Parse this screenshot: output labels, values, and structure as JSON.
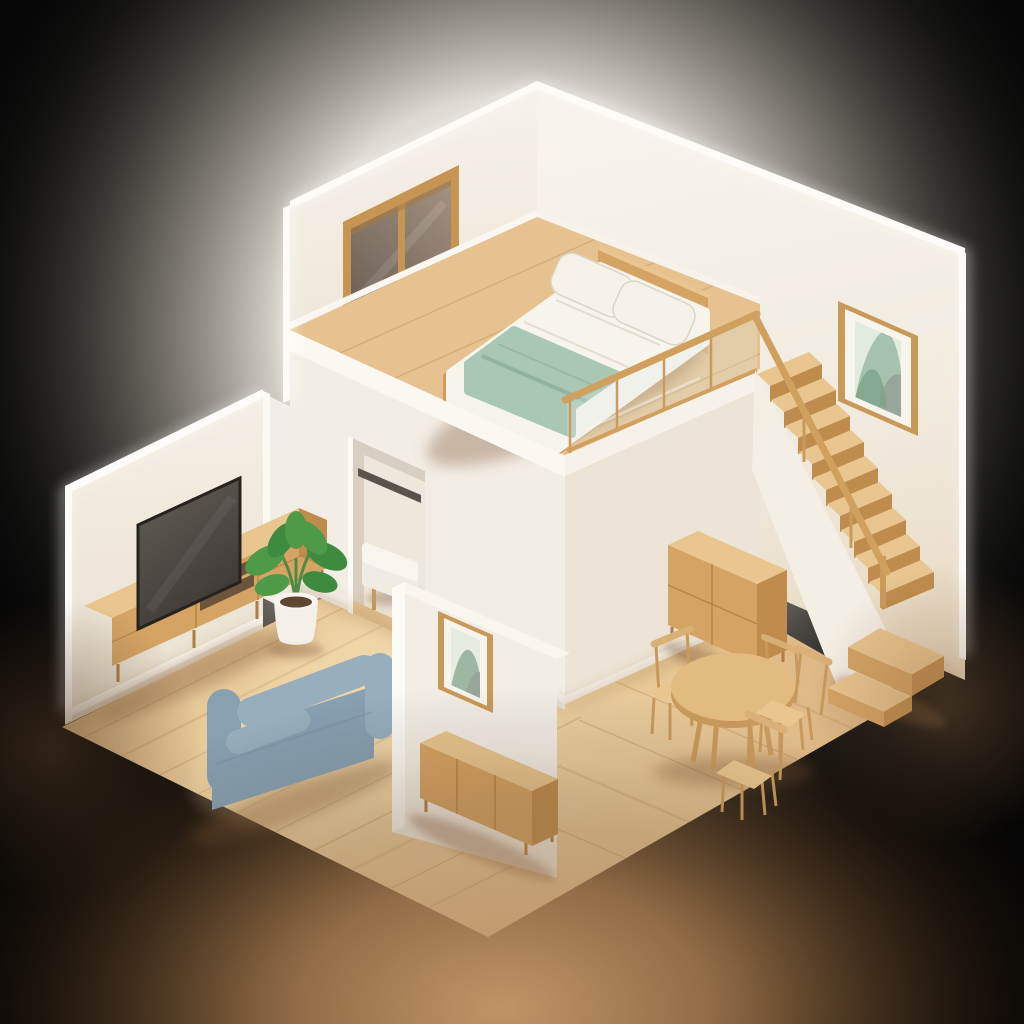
{
  "scene": {
    "type": "isometric-room-render",
    "description": "Isometric 3D cutaway render of a minimalist loft apartment: mezzanine bedroom with double bed, window and glass railing above; wooden staircase down the right wall; living area with TV, media console, potted plant and blue sofa; dining corner with round wooden table and chairs; framed green art prints; warm glow on black background",
    "style": "soft 3D render, warm minimalist, black vignette background with white halo and warm amber floor glow",
    "background": {
      "base": "#050505",
      "halo": "#ffffff",
      "warm_glow": "#b98a58"
    },
    "palette": {
      "wall": "#f3eee5",
      "wall2": "#ece4d6",
      "wall3": "#e9dfcf",
      "bright": "#fcfaf5",
      "wood": "#d5a464",
      "wood2": "#cf9c5c",
      "wood3": "#c08c4e",
      "woodTop": "#e9c68f",
      "plank": "#a87a46",
      "duvet": "#f7f4ec",
      "duvetShade": "#e3dbcb",
      "blanket": "#a9c8b4",
      "blanket2": "#8fb19d",
      "sofa": "#87a0b2",
      "sofa2": "#97aebd",
      "sofa3": "#7a93a6",
      "tv": "#45403b",
      "tv2": "#302c29",
      "leaf": "#4f9a47",
      "leaf2": "#3e8a3e",
      "pot": "#f4f0e8",
      "soil": "#5f4630",
      "glassPane": "#8d7d6f",
      "rail": "#cfa05e",
      "rod": "#5b534b",
      "artA": "#a4c2ac",
      "artB": "#7fa48c",
      "artC": "#98a59a",
      "artBg": "#e3ebdf"
    },
    "rooms": [
      {
        "name": "loft-bedroom",
        "level": "mezzanine"
      },
      {
        "name": "living-area",
        "level": "ground"
      },
      {
        "name": "dining-corner",
        "level": "ground"
      },
      {
        "name": "closet-nook",
        "level": "ground"
      }
    ],
    "objects": [
      {
        "name": "double-bed",
        "parts": [
          "oak frame",
          "white duvet",
          "two white pillows",
          "sage green throw blanket",
          "oak headboard"
        ]
      },
      {
        "name": "window",
        "detail": "two-pane oak framed window on back-left wall"
      },
      {
        "name": "loft-railing",
        "detail": "oak top rail, thin posts, clear glass panels"
      },
      {
        "name": "staircase",
        "detail": "oak treads descending along right wall with white stringer, oak handrail, two box steps at base"
      },
      {
        "name": "framed-art-right-wall",
        "detail": "green abstract hills print, oak frame, white mat"
      },
      {
        "name": "framed-art-partition",
        "detail": "small green hill print, oak frame, white mat"
      },
      {
        "name": "tv",
        "detail": "dark flat-screen on stand"
      },
      {
        "name": "tv-console",
        "detail": "oak media unit, drawers left and right, open middle shelf, slim legs"
      },
      {
        "name": "potted-plant",
        "detail": "white round pot, broad green leaves"
      },
      {
        "name": "sofa",
        "detail": "blue-grey three-seat sofa seen from behind, facing the TV"
      },
      {
        "name": "sideboard",
        "detail": "oak three-door cabinet at partition wall"
      },
      {
        "name": "chest-of-drawers",
        "detail": "oak 2x2 drawer chest under the loft"
      },
      {
        "name": "dining-table",
        "detail": "round oak pedestal table"
      },
      {
        "name": "dining-chairs",
        "count": 4,
        "detail": "oak chairs around the table"
      },
      {
        "name": "closet-doorway",
        "detail": "open doorway under loft with dark rail and white upholstered stool inside"
      },
      {
        "name": "wood-floor",
        "detail": "light oak planks, direction change between living and dining zones"
      }
    ]
  }
}
